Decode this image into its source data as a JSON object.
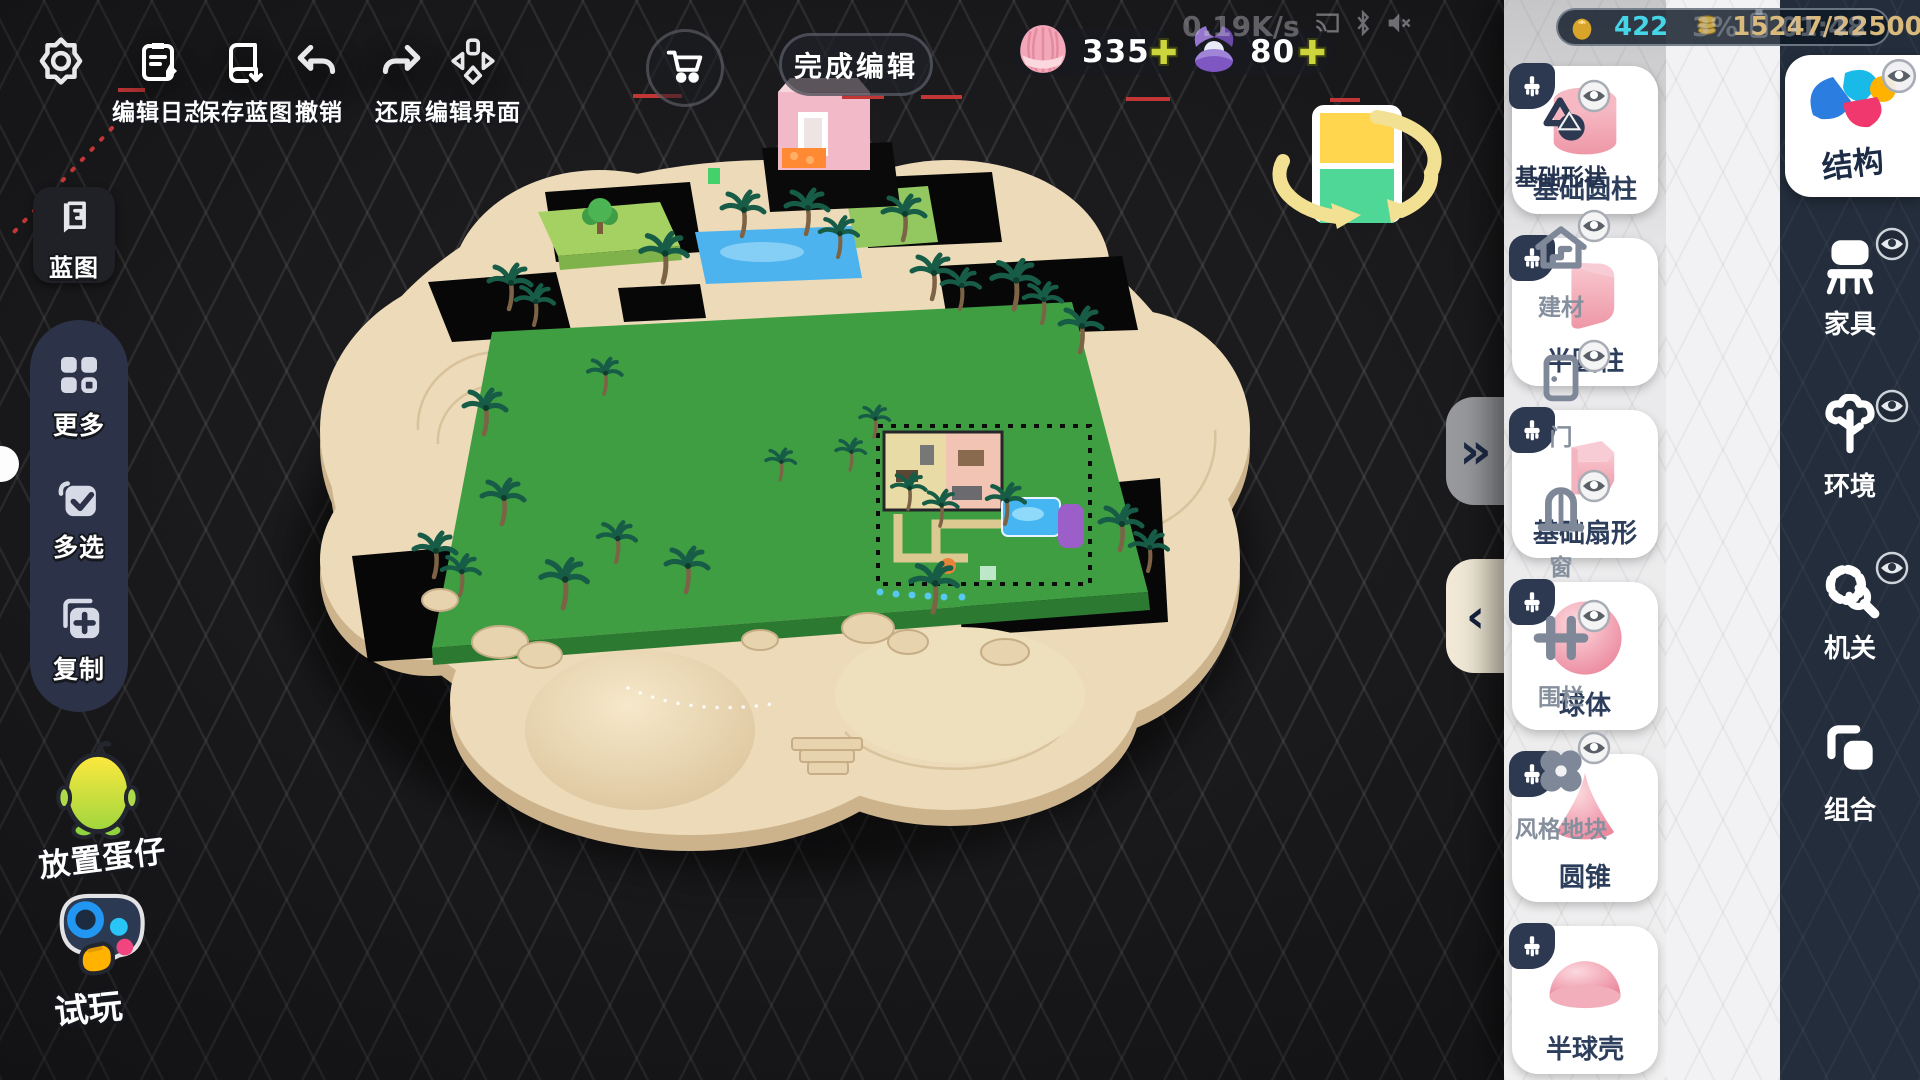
{
  "top_toolbar": {
    "buttons": [
      {
        "label": "编辑日志",
        "icon": "edit-log"
      },
      {
        "label": "保存蓝图",
        "icon": "save-blueprint"
      },
      {
        "label": "撤销",
        "icon": "undo"
      },
      {
        "label": "还原",
        "icon": "redo"
      },
      {
        "label": "编辑界面",
        "icon": "edit-ui"
      }
    ],
    "finish_label": "完成编辑"
  },
  "currency": {
    "shells": "335",
    "pearls": "80",
    "plus": "✚"
  },
  "status": {
    "net_speed": "0.19K/s",
    "battery": "3%",
    "time": "01:48",
    "egg_count": "422",
    "capacity": "15247/22500"
  },
  "left_sidebar": {
    "blueprint": "蓝图",
    "more": "更多",
    "multi_select": "多选",
    "copy": "复制",
    "place_egg": "放置蛋仔",
    "test_play": "试玩"
  },
  "right_panel": {
    "items": [
      {
        "label": "基础圆柱",
        "shape": "cylinder"
      },
      {
        "label": "半圆柱",
        "shape": "half-cylinder"
      },
      {
        "label": "基础扇形",
        "shape": "sector"
      },
      {
        "label": "球体",
        "shape": "sphere"
      },
      {
        "label": "圆锥",
        "shape": "cone"
      },
      {
        "label": "半球壳",
        "shape": "hemisphere-shell"
      }
    ],
    "subcategories": [
      {
        "label": "基础形状",
        "selected": true
      },
      {
        "label": "建材",
        "selected": false
      },
      {
        "label": "门",
        "selected": false
      },
      {
        "label": "窗",
        "selected": false
      },
      {
        "label": "围栏",
        "selected": false
      },
      {
        "label": "风格地块",
        "selected": false
      }
    ],
    "tabs": [
      {
        "label": "结构",
        "selected": true
      },
      {
        "label": "家具",
        "selected": false
      },
      {
        "label": "环境",
        "selected": false
      },
      {
        "label": "机关",
        "selected": false
      },
      {
        "label": "组合",
        "selected": false
      }
    ],
    "search_placeholder": "搜索",
    "expand_glyph": "»",
    "collapse_glyph": "‹"
  },
  "colors": {
    "field_green": "#3f9d42",
    "sand": "#ecdab8",
    "water_blue": "#4db3ef",
    "item_pink": "#f2a7b4",
    "panel_navy": "#232d3b",
    "gizmo_yellow": "#ffd64e",
    "gizmo_green": "#4ed796"
  }
}
